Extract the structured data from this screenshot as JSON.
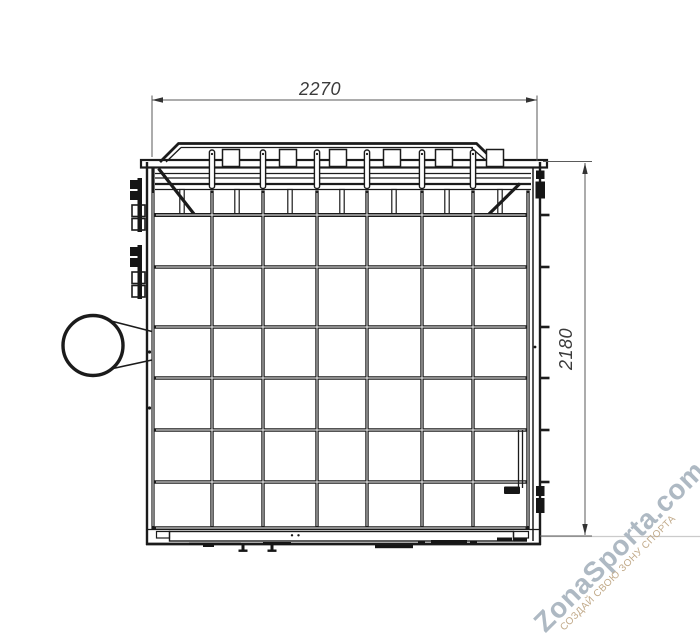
{
  "dimensions": {
    "width": "2270",
    "height": "2180"
  },
  "watermark": {
    "brand": "ZonaSporta.com",
    "tagline": "СОЗДАЙ СВОЮ ЗОНУ СПОРТА"
  },
  "colors": {
    "line": "#1b1b1b",
    "dimension": "#4f4f4f",
    "brand": "#aeb9c3",
    "tagline": "#c2ab8b",
    "ground": "#cbcbcb"
  },
  "grid": {
    "columns": 7,
    "rows": 6
  }
}
